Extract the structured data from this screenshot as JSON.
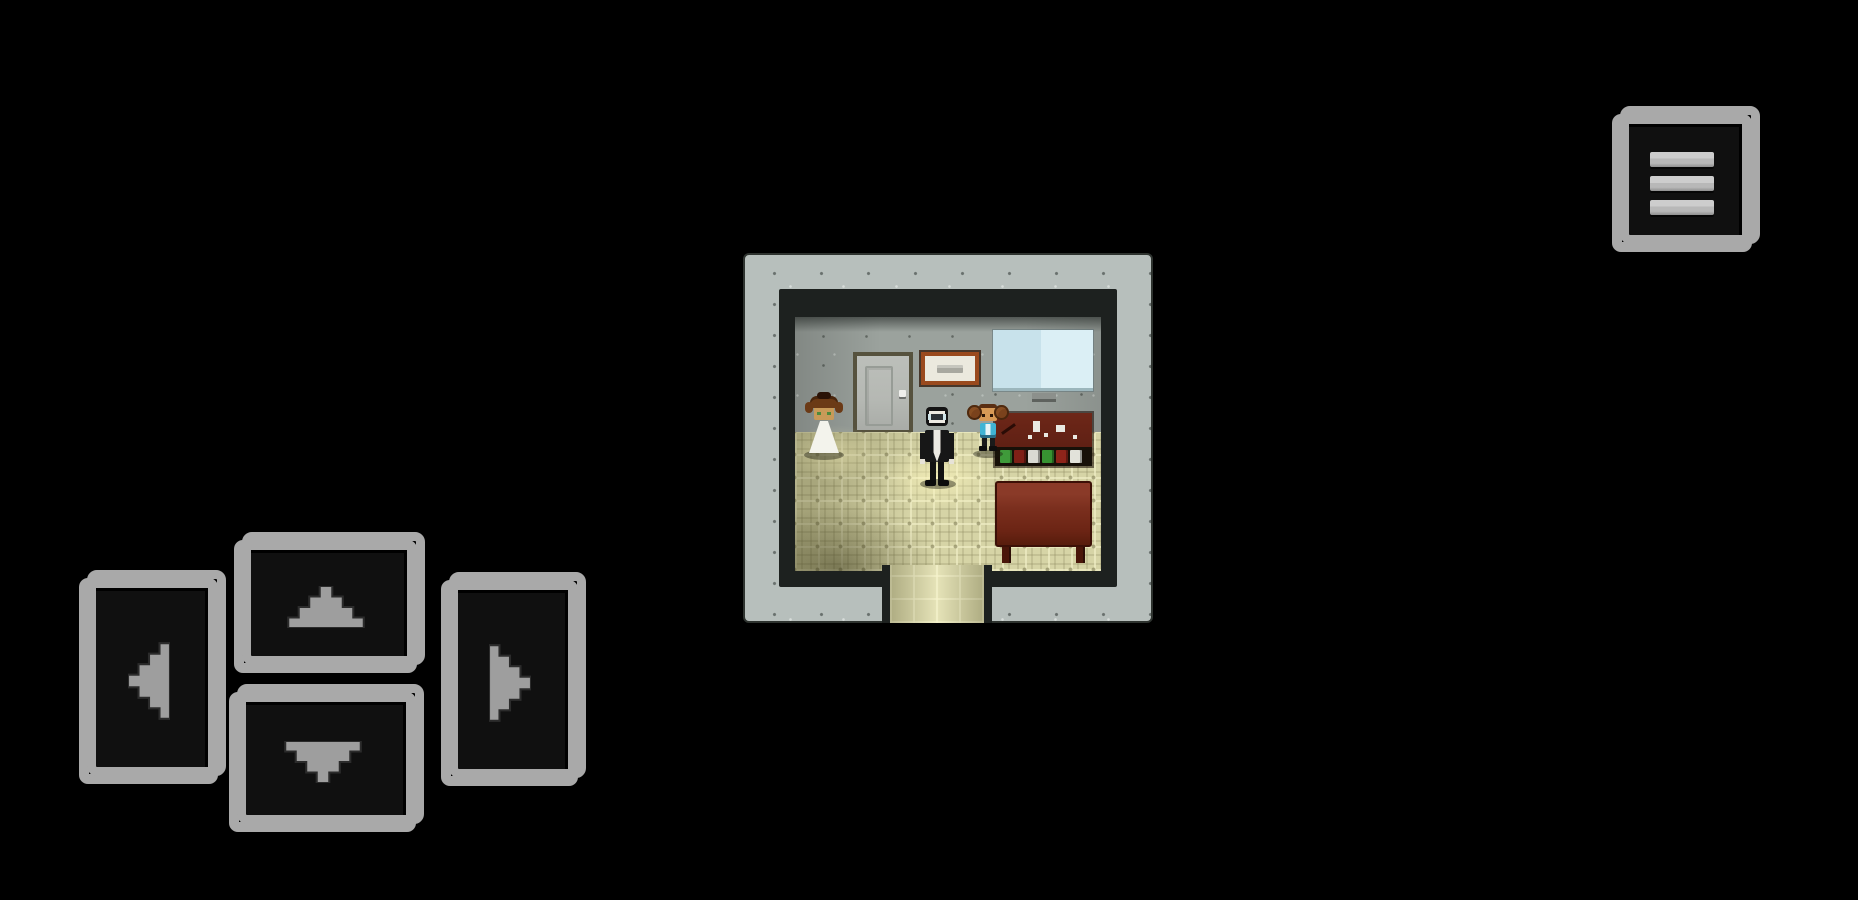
{
  "hud": {
    "menu_button": {
      "icon": "hamburger-menu-icon",
      "aria_label": "menu"
    },
    "dpad": {
      "buttons": [
        {
          "id": "up",
          "icon": "arrow-up-icon",
          "aria_label": "move up"
        },
        {
          "id": "left",
          "icon": "arrow-left-icon",
          "aria_label": "move left"
        },
        {
          "id": "right",
          "icon": "arrow-right-icon",
          "aria_label": "move right"
        },
        {
          "id": "down",
          "icon": "arrow-down-icon",
          "aria_label": "move down"
        }
      ]
    }
  },
  "scene": {
    "room": {
      "structure": [
        "speckled-concrete-outer-wall",
        "dark-inner-lining",
        "gray-back-wall",
        "khaki-tiled-floor",
        "doorway-opening-bottom-center"
      ],
      "fixtures": [
        {
          "id": "door",
          "desc": "gray interior door with recessed panel and light handle"
        },
        {
          "id": "notice-board",
          "desc": "brown-framed white notice with gray text bar"
        },
        {
          "id": "whiteboard",
          "desc": "pale blue wall screen with small mount bracket"
        }
      ],
      "furniture": [
        {
          "id": "desk",
          "desc": "dark red-brown desk with papers and tools on top"
        },
        {
          "id": "bookshelf-row",
          "spine_colors": [
            "#3f9a3a",
            "#7e1f16",
            "#d9d9d2",
            "#379231",
            "#8e241a",
            "#e2e2da"
          ]
        },
        {
          "id": "table",
          "desc": "red-brown table with dark legs"
        }
      ],
      "characters": [
        {
          "id": "bride",
          "desc": "woman with brown updo hair and white dress"
        },
        {
          "id": "man-in-suit",
          "desc": "man with black suit, white shirt and glasses, standing in light pool"
        },
        {
          "id": "girl-child",
          "desc": "child with brown pigtail buns and cyan shirt"
        }
      ]
    }
  },
  "colors": {
    "bg": "#000000",
    "frame": "#a9a9a9",
    "btn-face": "#101010",
    "arrow": "#9e9e9e",
    "bar": "#b8b8b8",
    "wall-outer": "#b7bfbc",
    "wall-lining": "#1d211f",
    "wall-inner": "#9ba29d",
    "floor": "#d6d4a6",
    "door-frame": "#56523e",
    "door-face": "#b5b8b3",
    "notice-frame": "#9a4a1e",
    "notice-face": "#ebe9de",
    "board-face": "#dbeff5",
    "desk": "#5f2014",
    "shelf": "#171008",
    "table": "#7b2f1e",
    "table-leg": "#4a160a",
    "dress": "#f3f3ec",
    "skin": "#c89a58",
    "suit": "#171717",
    "shirt": "#eceae2",
    "child-shirt": "#41b4d4",
    "child-skin": "#d89a56"
  }
}
